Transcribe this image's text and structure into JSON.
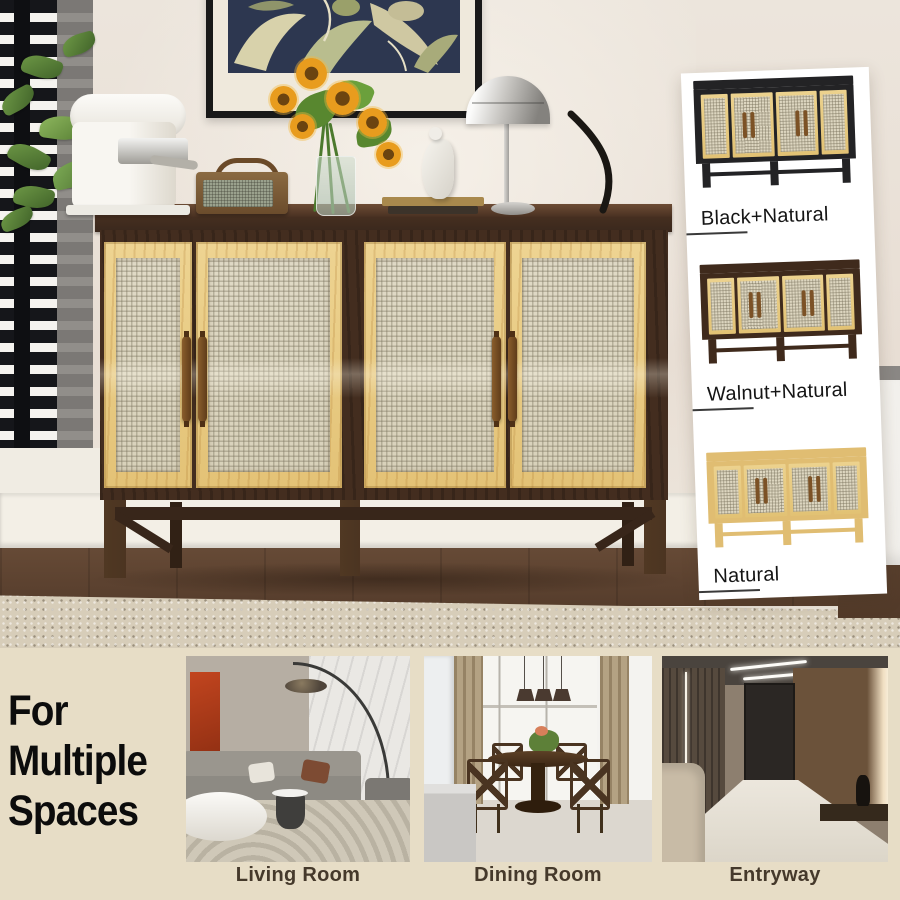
{
  "hero": {
    "description": "Walnut sideboard with four rattan mesh doors styled with coffee machine, radio, sunflowers, figurine and mushroom lamp",
    "props": {
      "coffee_machine": "white espresso machine",
      "radio": "vintage wood speaker",
      "flowers": "sunflower bouquet in glass vase",
      "figurine": "white abstract sculpture",
      "lamp": "chrome mushroom table lamp",
      "wall_art": "navy botanical framed print"
    }
  },
  "variants": {
    "items": [
      {
        "label": "Black+Natural",
        "frame_hex": "#232325",
        "door_hex": "#e2c276"
      },
      {
        "label": "Walnut+Natural",
        "frame_hex": "#3f2a1c",
        "door_hex": "#e2c276"
      },
      {
        "label": "Natural",
        "frame_hex": "#e0bd72",
        "door_hex": "#e8cc88"
      }
    ]
  },
  "footer": {
    "heading_lines": [
      "For",
      "Multiple",
      "Spaces"
    ],
    "rooms": [
      {
        "label": "Living Room"
      },
      {
        "label": "Dining Room"
      },
      {
        "label": "Entryway"
      }
    ]
  },
  "colors": {
    "wall": "#eae1d7",
    "band": "#e7ddc6",
    "headline": "#0c0c0c",
    "roomlabel": "#45392b",
    "vlabel": "#151515",
    "card": "#ffffff"
  }
}
